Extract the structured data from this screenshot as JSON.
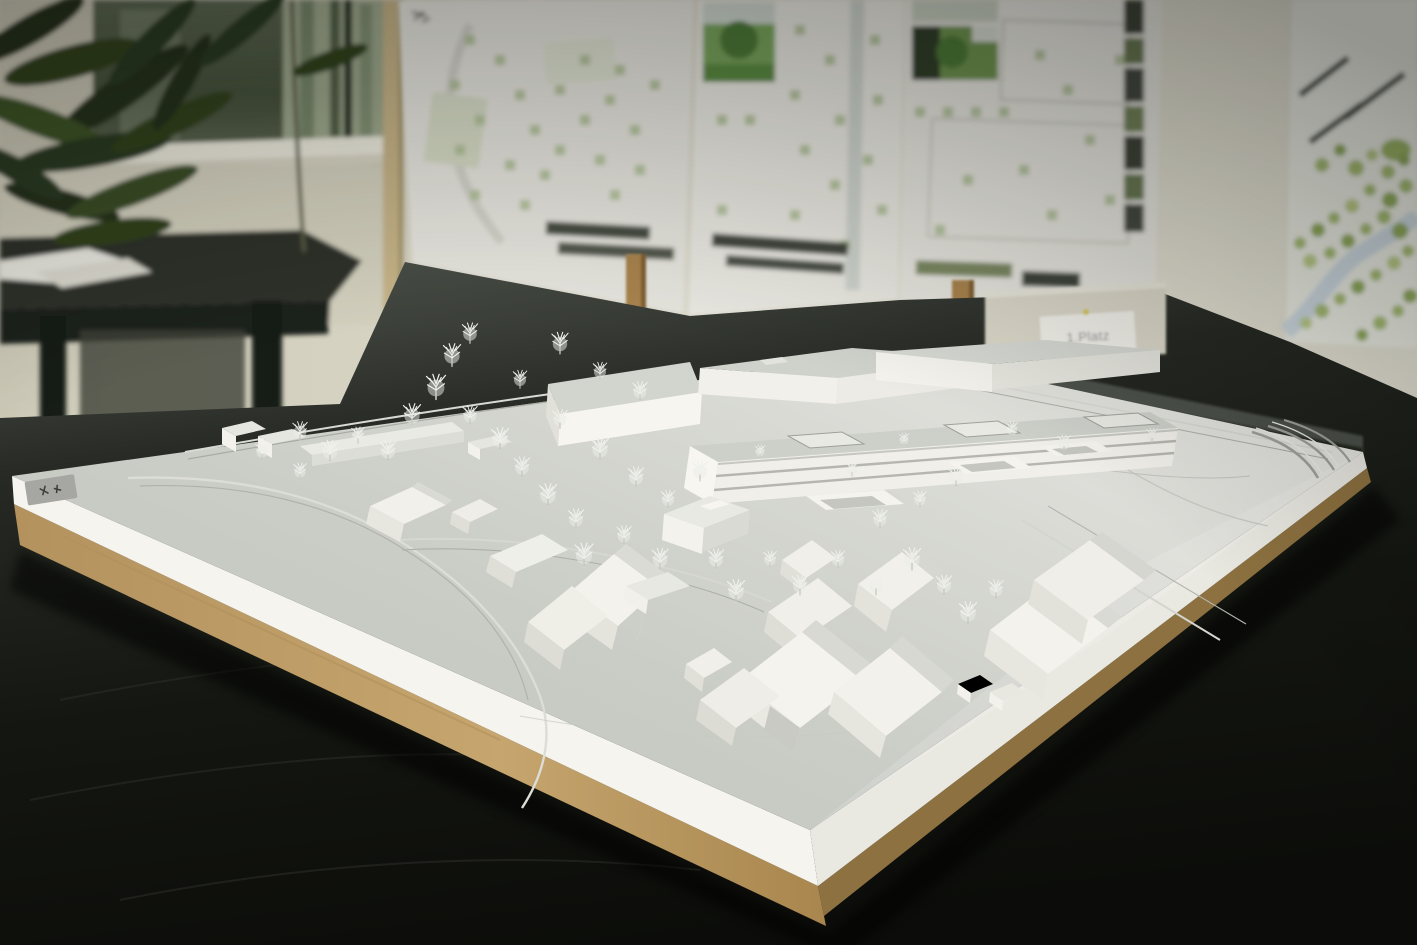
{
  "scene": {
    "award_label": "1.Platz"
  },
  "background": {
    "poster_count": 4,
    "poster_content": [
      "site-plan-bw",
      "site-plan-with-photos",
      "floor-plan-with-photos",
      "colored-landscape-plan"
    ]
  },
  "colors": {
    "wall": "#ddd9c9",
    "poster_paper": "#e9e8e1",
    "plan_green": "#aebf94",
    "photo_green": "#79a55b",
    "river_blue": "#ccd9e2",
    "glass_reflection": "#b8c3a6",
    "plant_green": "#2c3b21",
    "wood_post": "#a8834e",
    "table_dark": "#141510",
    "table_sheen": "#565b53",
    "model_surface": "#c9cbc5",
    "model_fascia": "#f5f4ee",
    "mdf_base": "#c0a169",
    "mdf_shadow": "#8d7140",
    "sticker_gray": "#a6a6a2",
    "card_white": "#f2f1ea"
  }
}
